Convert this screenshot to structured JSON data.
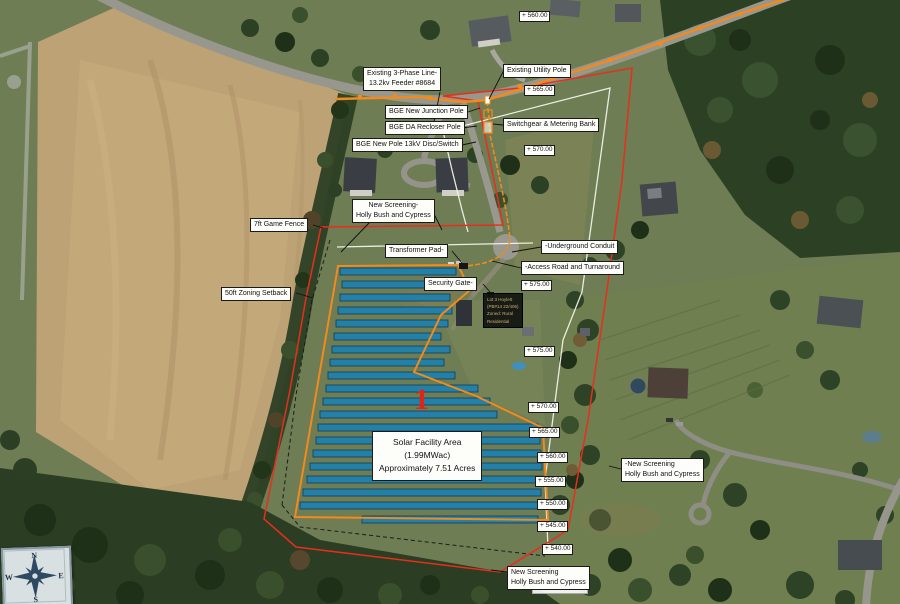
{
  "map": {
    "marker_number": "1",
    "colors": {
      "property_boundary_red": "#e82e1c",
      "fence_orange": "#f28a1e",
      "survey_white": "#f2f2ea",
      "panel_blue": "#1d80ae",
      "field_tan": "#bda275",
      "forest_green": "#2c4024"
    },
    "labels": {
      "existing_line": [
        "Existing 3-Phase Line-",
        "13.2kv Feeder #8684"
      ],
      "existing_pole": "Existing Utility Pole",
      "junction_pole": "BGE New Junction Pole",
      "switchgear": "Switchgear & Metering Bank",
      "recloser": "BGE DA Recloser Pole",
      "new_pole": "BGE New Pole 13kV Disc/Switch",
      "screening_top": [
        "New Screening-",
        "Holly Bush and Cypress"
      ],
      "game_fence": "7ft Game Fence",
      "transformer": "Transformer Pad-",
      "conduit": "-Underground Conduit",
      "access_road": "-Access Road and Turnaround",
      "security_gate": "Security Gate-",
      "setback": "50ft Zoning Setback",
      "solar_area": [
        "Solar Facility Area",
        "(1.99MWac)",
        "Approximately 7.51 Acres"
      ],
      "screening_right": [
        "-New Screening",
        "Holly Bush and Cypress"
      ],
      "screening_bottom": [
        "New Screening",
        "Holly Bush and Cypress"
      ]
    },
    "lot_note": [
      "Lot 3 Hoylett",
      "(PB#14 22/406)",
      "Zoned: Rural",
      "Residential"
    ],
    "elevations": [
      "+ 560.00",
      "+ 565.00",
      "+ 570.00",
      "+ 575.00",
      "+ 575.00",
      "+ 570.00",
      "+ 565.00",
      "+ 560.00",
      "+ 555.00",
      "+ 550.00",
      "+ 545.00",
      "+ 540.00"
    ],
    "compass": {
      "n": "N",
      "e": "E",
      "s": "S",
      "w": "W"
    },
    "solar_rows": [
      [
        268,
        340,
        456
      ],
      [
        281,
        342,
        453
      ],
      [
        294,
        340,
        450
      ],
      [
        307,
        338,
        452
      ],
      [
        320,
        336,
        448
      ],
      [
        333,
        334,
        441
      ],
      [
        346,
        332,
        450
      ],
      [
        359,
        330,
        444
      ],
      [
        372,
        328,
        455
      ],
      [
        385,
        326,
        478
      ],
      [
        398,
        323,
        490
      ],
      [
        411,
        320,
        497
      ],
      [
        424,
        318,
        538
      ],
      [
        437,
        316,
        540
      ],
      [
        450,
        313,
        541
      ],
      [
        463,
        310,
        542
      ],
      [
        476,
        307,
        543
      ],
      [
        489,
        303,
        541
      ],
      [
        502,
        300,
        540
      ],
      [
        516,
        362,
        538
      ]
    ]
  }
}
